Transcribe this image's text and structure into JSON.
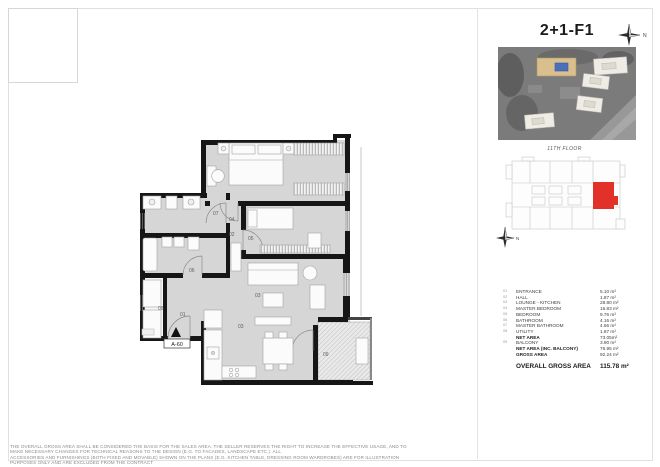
{
  "page": {
    "title": "2+1-F1",
    "floor_label": "11TH FLOOR",
    "north_label": "N"
  },
  "plan": {
    "entrance_marker": "A-60",
    "rooms": {
      "r01": "01",
      "r02": "02",
      "r03": "03",
      "r03b": "03",
      "r04": "04",
      "r05": "05",
      "r06": "06",
      "r07": "07",
      "r08": "08",
      "r09": "09"
    }
  },
  "legend": {
    "rows": [
      {
        "num": "01",
        "name": "ENTRANCE",
        "area": "5.10 m²"
      },
      {
        "num": "02",
        "name": "HALL",
        "area": "1.87 m²"
      },
      {
        "num": "03",
        "name": "LOUNGE - KITCHEN",
        "area": "28.80 m²"
      },
      {
        "num": "04",
        "name": "MASTER BEDROOM",
        "area": "16.83 m²"
      },
      {
        "num": "05",
        "name": "BEDROOM",
        "area": "9.76 m²"
      },
      {
        "num": "06",
        "name": "BATHROOM",
        "area": "4.16 m²"
      },
      {
        "num": "07",
        "name": "MASTER BATHROOM",
        "area": "4.66 m²"
      },
      {
        "num": "08",
        "name": "UTILITY",
        "area": "1.87 m²"
      },
      {
        "num": "",
        "name": "NET AREA",
        "area": "73.05m²"
      },
      {
        "num": "09",
        "name": "BALCONY",
        "area": "3.90 m²"
      },
      {
        "num": "",
        "name": "NET AREA (INC. BALCONY)",
        "area": "76.95 m²"
      },
      {
        "num": "",
        "name": "GROSS AREA",
        "area": "92.24 m²"
      }
    ],
    "overall": {
      "name": "OVERALL GROSS AREA",
      "area": "115.78 m²"
    }
  },
  "disclaimer": {
    "line1": "THE OVERALL GROSS AREA SHALL BE CONSIDERED THE BASIS FOR THE SALES AREA. THE SELLER RESERVES THE RIGHT TO INCREASE THE EFFECTIVE USAGE, AND TO MAKE NECESSARY CHANGES FOR TECHNICAL REASONS TO THE DESIGN (E.G. TO FACADES, LANDSCAPE ETC.). ALL",
    "line2": "ACCESSORIES AND FURNISHINGS (BOTH FIXED AND MOVABLE) SHOWN ON THE PLANS (E.G. KITCHEN TABLE, DRESSING ROOM WARDROBES) ARE FOR ILLUSTRATION PURPOSES ONLY AND ARE EXCLUDED FROM THE CONTRACT"
  },
  "colors": {
    "unit_highlight": "#e23128",
    "building_highlight": "#d8bf8d",
    "floor_fill": "#d6d6d6",
    "wall": "#161616"
  }
}
